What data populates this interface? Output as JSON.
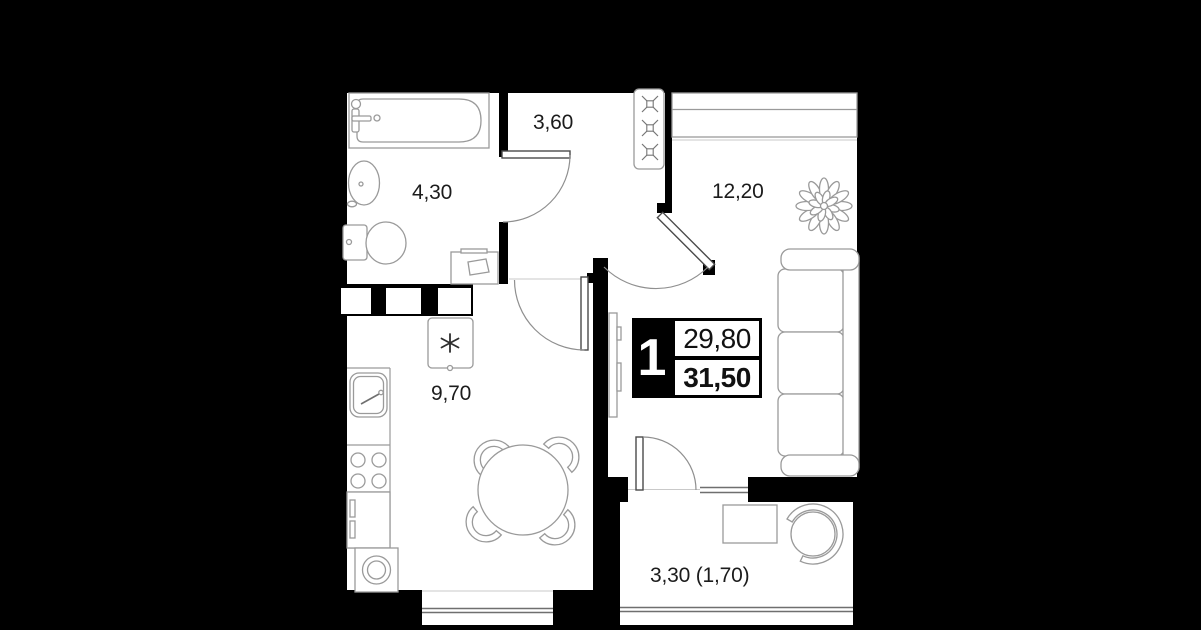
{
  "badge": {
    "room_count": "1",
    "upper_area": "29,80",
    "lower_area": "31,50"
  },
  "areas": {
    "hallway": "3,60",
    "bathroom": "4,30",
    "living_room": "12,20",
    "kitchen": "9,70",
    "balcony": "3,30 (1,70)"
  },
  "colors": {
    "background": "#000000",
    "walls": "#000000",
    "floor": "#ffffff",
    "fixture_lines": "#9a9a9a",
    "door_lines": "#4a4a4a",
    "text": "#1c1c1c",
    "badge_block": "#000000",
    "badge_text_on_block": "#ffffff"
  }
}
